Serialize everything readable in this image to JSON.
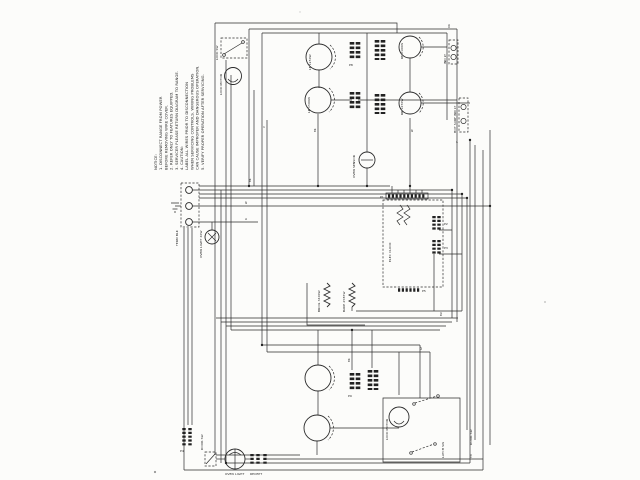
{
  "diagram": {
    "notice": {
      "lines": [
        "NOTICE:",
        "1. DISCONNECT RANGE FROM POWER",
        "   BEFORE REMOVING WIRE COVER.",
        "2. REFER ONLY TO FEATURES EQUIPPED.",
        "3. SERVICER PLEASE RETURN DIAGRAM TO RANGE.",
        "4. CAUTION:",
        "   LABEL ALL WIRES PRIOR TO DISCONNECTION",
        "   WHEN SERVICING CONTROLS. WIRING PROBLEMS",
        "   CAN CAUSE IMPROPER AND DANGEROUS OPERATION.",
        "5. VERIFY PROPER OPERATION AFTER SERVICING."
      ]
    },
    "labels": {
      "lock_sw": "LOCK SW",
      "lock_motor_upper": "LOCK MOTOR",
      "lock_motor_lower": "LOCK MOTOR",
      "lf": "LF 1250W",
      "lr": "LR 1500W",
      "rf": "RF 2100W",
      "rr": "RR 1250W",
      "ind_lt": "IND LT",
      "hot_surf": "HOT SURF IND LT",
      "term": "TERM BLK",
      "oven_light_mid": "OVEN LIGHT 40W",
      "sensor": "OVEN SENSOR",
      "clock": "ELEC CLOCK",
      "broil": "BROIL 3400W",
      "bake": "BAKE 2585W",
      "p1": "P1",
      "p2": "P2",
      "p3": "P3",
      "p4": "P4",
      "p5": "P5",
      "p8": "P8",
      "p9": "P9",
      "door_sw": "DOOR SW",
      "latch_sw": "LATCH SW",
      "oven_light_bottom": "OVEN LIGHT",
      "recept": "RECEPT",
      "wire_marks": [
        "BK",
        "W",
        "R",
        "OR",
        "Y",
        "BU",
        "GY",
        "V",
        "BR",
        "TN",
        "BK",
        "W"
      ]
    }
  }
}
